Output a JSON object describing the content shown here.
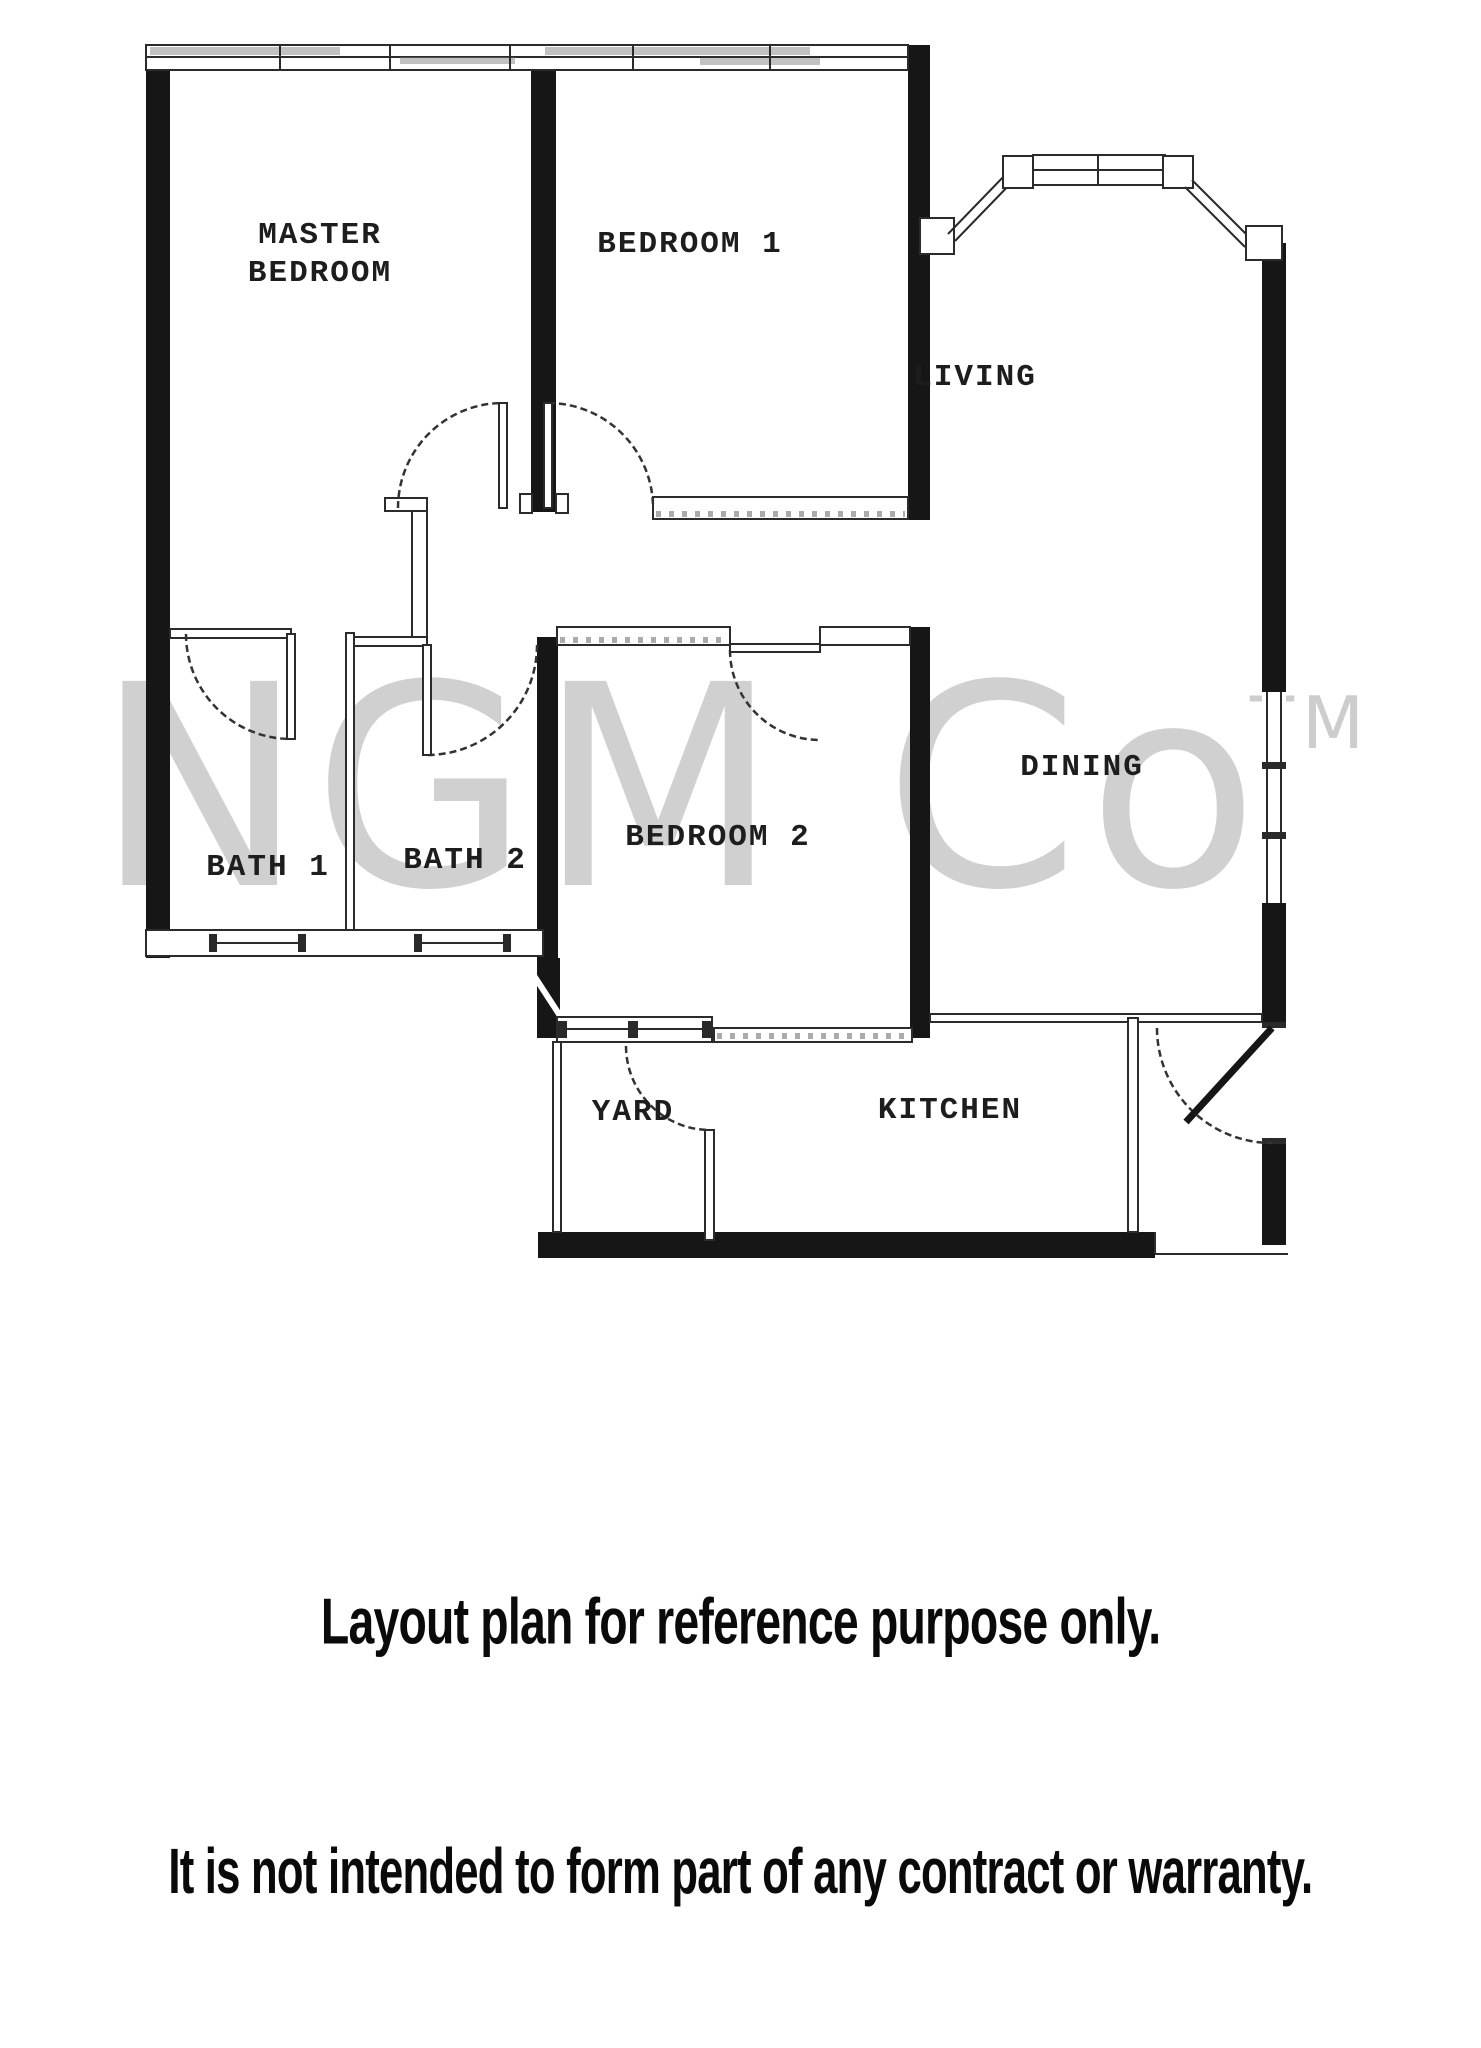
{
  "watermark": {
    "text": "NGM Co",
    "tm": "TM"
  },
  "rooms": {
    "master_line1": "MASTER",
    "master_line2": "BEDROOM",
    "bedroom1": "BEDROOM 1",
    "living": "LIVING",
    "dining": "DINING",
    "bath1": "BATH 1",
    "bath2": "BATH 2",
    "bedroom2": "BEDROOM 2",
    "yard": "YARD",
    "kitchen": "KITCHEN"
  },
  "footer": {
    "line1": "Layout plan for reference purpose only.",
    "line2": "It is not intended to form part of any contract or warranty."
  },
  "colors": {
    "wall": "#161616",
    "line": "#2b2b2b",
    "label": "#1d1d1d",
    "watermark": "#c8c8c8",
    "background": "#ffffff"
  }
}
